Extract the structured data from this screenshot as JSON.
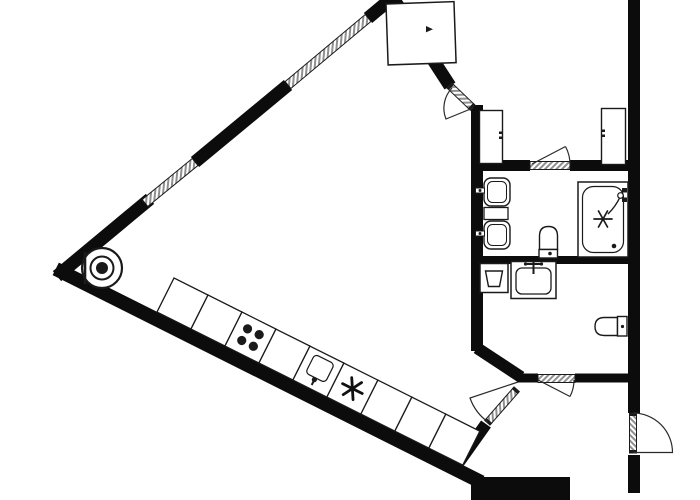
{
  "plan": {
    "title_hidden": "",
    "colors": {
      "wall": "#0c0c0c",
      "line": "#1a1a1a",
      "hatch": "#8f8f8f",
      "bg": "#ffffff"
    },
    "window_count": 2,
    "door_count": 5,
    "closet_count": 3,
    "kitchen": {
      "unit_count": 9,
      "stove_burners": 4,
      "unit_icons": [
        "plain",
        "plain",
        "stove-burners-icon",
        "plain",
        "kitchen-sink-icon",
        "freezer-asterisk-icon",
        "plain",
        "plain",
        "plain"
      ]
    },
    "bathroom_fixtures": [
      "washbasin-icon",
      "washbasin-icon",
      "toilet-icon",
      "bathtub-icon",
      "shower-mixer-icon"
    ],
    "wc_fixtures": [
      "washing-machine-icon",
      "washbasin-icon",
      "toilet-icon"
    ],
    "other_symbols": [
      "corner-column-icon",
      "wardrobe",
      "closet",
      "closet",
      "entrance-door",
      "window-band",
      "window-band"
    ]
  }
}
